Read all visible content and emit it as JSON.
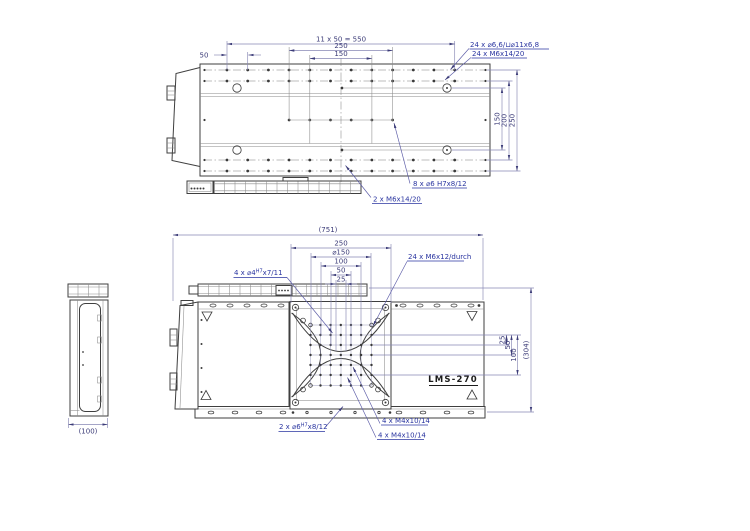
{
  "drawing_label": "LMS-270",
  "colors": {
    "outline": "#3f3f3f",
    "dimension_line": "#8787b4",
    "dimension_text": "#3c3c78",
    "annotation_text": "#2a35a0",
    "background": "#ffffff"
  },
  "top_view": {
    "dim_pitch": "11 x 50 = 550",
    "dim_250": "250",
    "dim_150": "150",
    "dim_50": "50",
    "right_dim_150": "150",
    "right_dim_200": "200",
    "right_dim_250": "250",
    "note_counterbore": "24 x ⌀6,6/⊔⌀11x6,8",
    "note_m6": "24 x M6x14/20",
    "note_dowel": "8 x ⌀6 H7x8/12",
    "note_m6_chain": "2 x M6x14/20"
  },
  "front_view": {
    "dim_total": "(751)",
    "dim_height": "(304)",
    "dim_250": "250",
    "dim_150": "⌀150",
    "dim_100": "100",
    "dim_50": "50",
    "dim_25": "25",
    "right_dim_25": "25",
    "right_dim_50": "50",
    "right_dim_100": "100",
    "note_m6_through": "24 x M6x12/durch",
    "note_pin4_pre": "4 x ⌀4",
    "note_pin4_sup": "H7",
    "note_pin4_post": "x7/11",
    "note_pin6_pre": "2 x ⌀6",
    "note_pin6_sup": "H7",
    "note_pin6_post": "x8/12",
    "note_m4_top": "4 x M4x10/14",
    "note_m4_bottom": "4 x M4x10/14",
    "label": "LMS-270"
  },
  "side_view": {
    "dim_width": "(100)"
  }
}
